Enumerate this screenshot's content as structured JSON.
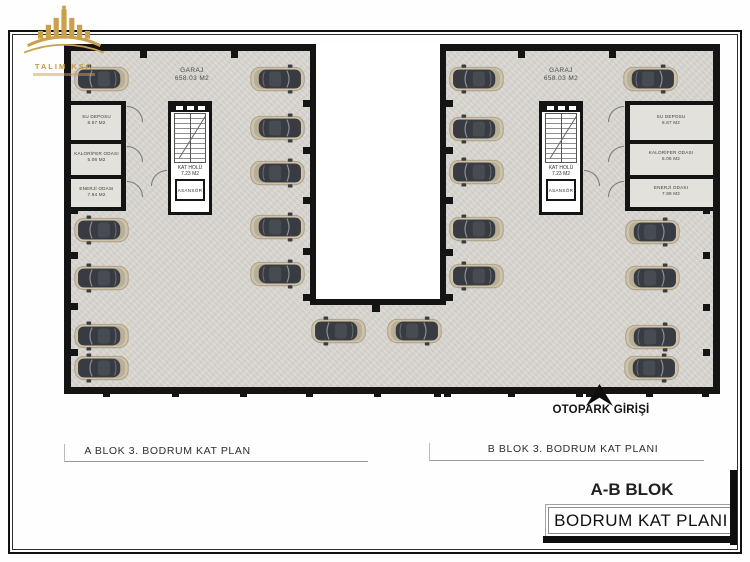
{
  "logo": {
    "title": "TALIM KSA"
  },
  "plan": {
    "garage_a": {
      "name": "GARAJ",
      "area": "658.03 M2"
    },
    "garage_b": {
      "name": "GARAJ",
      "area": "658.03 M2"
    },
    "rooms_a": [
      {
        "name": "SU DEPOSU",
        "area": "8.67 M2"
      },
      {
        "name": "KALORİFER ODASI",
        "area": "5.06 M2"
      },
      {
        "name": "ENERJİ ODASI",
        "area": "7.94 M2"
      }
    ],
    "rooms_b": [
      {
        "name": "SU DEPOSU",
        "area": "8.67 M2"
      },
      {
        "name": "KALORİFER ODASI",
        "area": "5.06 M2"
      },
      {
        "name": "ENERJİ ODASI",
        "area": "7.99 M2"
      }
    ],
    "core": {
      "hall": "KAT HOLÜ",
      "hall_area": "7.23 M2",
      "elevator": "ASANSÖR"
    },
    "entrance": "OTOPARK GİRİŞİ",
    "caption_a": "A BLOK 3. BODRUM KAT PLAN",
    "caption_b": "B BLOK 3. BODRUM KAT PLANI"
  },
  "title_block": {
    "block": "A-B BLOK",
    "plan": "BODRUM KAT PLANI"
  },
  "colors": {
    "wall": "#141414",
    "floor": "#dad7d1",
    "gold": "#c39a3d",
    "car_body": "#cdc2ab",
    "car_cabin": "#383b41"
  },
  "plan_geometry": {
    "walls": [
      {
        "x": 64,
        "y": 44,
        "w": 252,
        "h": 7
      },
      {
        "x": 440,
        "y": 44,
        "w": 280,
        "h": 7
      },
      {
        "x": 64,
        "y": 44,
        "w": 7,
        "h": 350
      },
      {
        "x": 713,
        "y": 44,
        "w": 7,
        "h": 350
      },
      {
        "x": 64,
        "y": 387,
        "w": 656,
        "h": 7
      },
      {
        "x": 310,
        "y": 44,
        "w": 6,
        "h": 261
      },
      {
        "x": 440,
        "y": 44,
        "w": 6,
        "h": 261
      },
      {
        "x": 310,
        "y": 299,
        "w": 136,
        "h": 6
      },
      {
        "x": 121,
        "y": 101,
        "w": 5,
        "h": 110
      },
      {
        "x": 64,
        "y": 101,
        "w": 62,
        "h": 4
      },
      {
        "x": 64,
        "y": 140,
        "w": 62,
        "h": 4
      },
      {
        "x": 64,
        "y": 175,
        "w": 62,
        "h": 4
      },
      {
        "x": 64,
        "y": 207,
        "w": 62,
        "h": 4
      },
      {
        "x": 625,
        "y": 101,
        "w": 5,
        "h": 110
      },
      {
        "x": 625,
        "y": 101,
        "w": 95,
        "h": 4
      },
      {
        "x": 625,
        "y": 140,
        "w": 95,
        "h": 4
      },
      {
        "x": 625,
        "y": 175,
        "w": 95,
        "h": 4
      },
      {
        "x": 625,
        "y": 207,
        "w": 95,
        "h": 4
      }
    ],
    "marks": [
      {
        "x": 71,
        "y": 207
      },
      {
        "x": 71,
        "y": 252
      },
      {
        "x": 71,
        "y": 303
      },
      {
        "x": 71,
        "y": 349
      },
      {
        "x": 303,
        "y": 100
      },
      {
        "x": 303,
        "y": 147
      },
      {
        "x": 303,
        "y": 197
      },
      {
        "x": 303,
        "y": 248
      },
      {
        "x": 303,
        "y": 294
      },
      {
        "x": 446,
        "y": 100
      },
      {
        "x": 446,
        "y": 147
      },
      {
        "x": 446,
        "y": 197
      },
      {
        "x": 446,
        "y": 249
      },
      {
        "x": 446,
        "y": 294
      },
      {
        "x": 703,
        "y": 207
      },
      {
        "x": 703,
        "y": 252
      },
      {
        "x": 703,
        "y": 304
      },
      {
        "x": 703,
        "y": 349
      },
      {
        "x": 372,
        "y": 303,
        "w": 8,
        "h": 9
      },
      {
        "x": 140,
        "y": 51
      },
      {
        "x": 231,
        "y": 51
      },
      {
        "x": 518,
        "y": 51
      },
      {
        "x": 609,
        "y": 51
      },
      {
        "x": 103,
        "y": 390
      },
      {
        "x": 172,
        "y": 390
      },
      {
        "x": 240,
        "y": 390
      },
      {
        "x": 306,
        "y": 390
      },
      {
        "x": 374,
        "y": 390
      },
      {
        "x": 434,
        "y": 390
      },
      {
        "x": 444,
        "y": 390
      },
      {
        "x": 508,
        "y": 390
      },
      {
        "x": 576,
        "y": 390
      },
      {
        "x": 586,
        "y": 390
      },
      {
        "x": 646,
        "y": 390
      },
      {
        "x": 702,
        "y": 390
      }
    ],
    "arcs": [
      {
        "x": 127,
        "y": 106,
        "t": "ne"
      },
      {
        "x": 127,
        "y": 146,
        "t": "ne"
      },
      {
        "x": 127,
        "y": 181,
        "t": "ne"
      },
      {
        "x": 608,
        "y": 106,
        "t": "nw"
      },
      {
        "x": 608,
        "y": 146,
        "t": "nw"
      },
      {
        "x": 608,
        "y": 181,
        "t": "nw"
      },
      {
        "x": 151,
        "y": 170,
        "t": "nw"
      },
      {
        "x": 584,
        "y": 170,
        "t": "ne"
      }
    ],
    "cars": [
      {
        "x": 101,
        "y": 79,
        "flip": false
      },
      {
        "x": 101,
        "y": 230,
        "flip": false
      },
      {
        "x": 101,
        "y": 278,
        "flip": false
      },
      {
        "x": 101,
        "y": 336,
        "flip": false
      },
      {
        "x": 101,
        "y": 368,
        "flip": false
      },
      {
        "x": 277,
        "y": 79,
        "flip": true
      },
      {
        "x": 277,
        "y": 128,
        "flip": true
      },
      {
        "x": 277,
        "y": 173,
        "flip": true
      },
      {
        "x": 277,
        "y": 227,
        "flip": true
      },
      {
        "x": 277,
        "y": 274,
        "flip": true
      },
      {
        "x": 338,
        "y": 331,
        "flip": false
      },
      {
        "x": 414,
        "y": 331,
        "flip": true
      },
      {
        "x": 476,
        "y": 79,
        "flip": false
      },
      {
        "x": 476,
        "y": 129,
        "flip": false
      },
      {
        "x": 476,
        "y": 172,
        "flip": false
      },
      {
        "x": 476,
        "y": 229,
        "flip": false
      },
      {
        "x": 476,
        "y": 276,
        "flip": false
      },
      {
        "x": 650,
        "y": 79,
        "flip": true
      },
      {
        "x": 652,
        "y": 232,
        "flip": true
      },
      {
        "x": 652,
        "y": 278,
        "flip": true
      },
      {
        "x": 652,
        "y": 337,
        "flip": true
      },
      {
        "x": 651,
        "y": 368,
        "flip": true
      }
    ]
  }
}
